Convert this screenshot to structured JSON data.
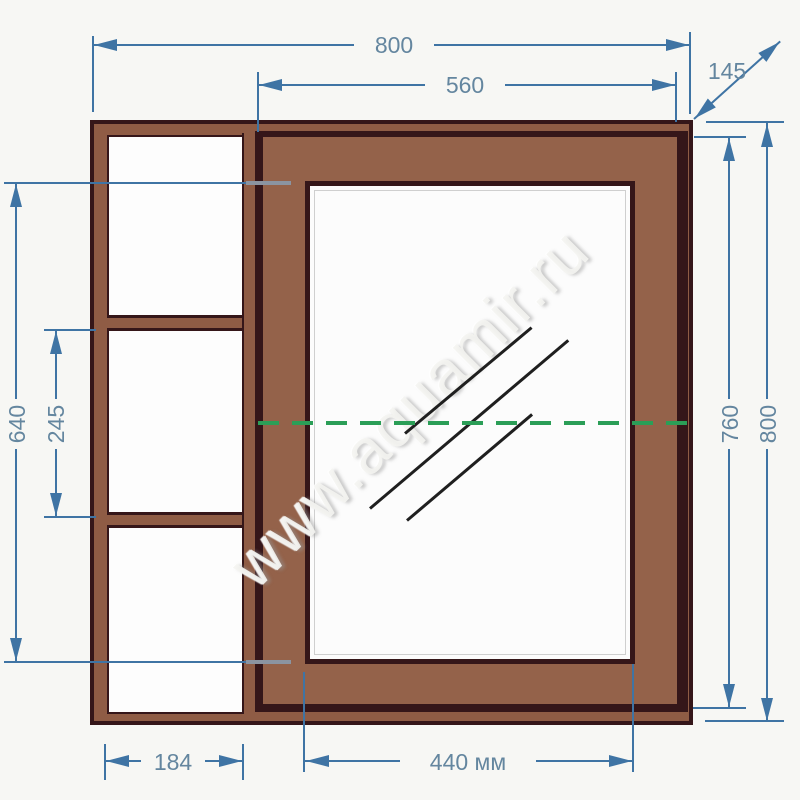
{
  "drawing": {
    "type": "furniture technical drawing",
    "subject": "mirror cabinet front view with open side shelves",
    "units_shown": "мм"
  },
  "watermark": {
    "text": "www.aquamir.ru"
  },
  "dims": {
    "top_width": {
      "label": "800",
      "meaning": "overall width"
    },
    "door_width_top": {
      "label": "560",
      "meaning": "door width"
    },
    "depth": {
      "label": "145",
      "meaning": "cabinet depth"
    },
    "door_height": {
      "label": "760",
      "meaning": "door height"
    },
    "total_height": {
      "label": "800",
      "meaning": "overall height"
    },
    "opening_height": {
      "label": "640",
      "meaning": "mirror/opening height"
    },
    "shelf_spacing": {
      "label": "245",
      "meaning": "spacing between shelves"
    },
    "shelf_width": {
      "label": "184",
      "meaning": "shelf inner width"
    },
    "mirror_width": {
      "label": "440 мм",
      "meaning": "mirror width"
    }
  },
  "colors": {
    "dimension_blue": "#3f74a4",
    "label_blue": "#64869f",
    "cabinet_brown": "#94624a",
    "outline_dark": "#351619",
    "axis_green": "#2b9e57",
    "mirror_white": "#fcfcfc",
    "background": "#f7f7f4"
  }
}
